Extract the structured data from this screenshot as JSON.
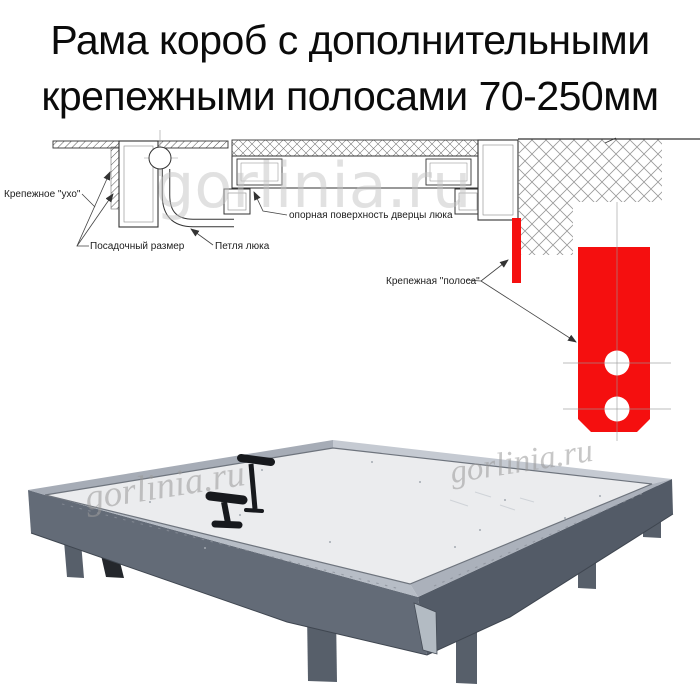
{
  "title": {
    "line1": "Рама короб с дополнительными",
    "line2": "крепежными полосами 70-250мм"
  },
  "diagram": {
    "labels": {
      "fastening_ear": "Крепежное \"ухо\"",
      "mounting_size": "Посадочный размер",
      "hatch_hinge": "Петля люка",
      "bearing_surface": "опорная поверхность дверцы люка",
      "fastening_strip": "Крепежная \"полоса\""
    }
  },
  "watermark": {
    "text": "gorlinia.ru"
  },
  "colors": {
    "strip_red": "#f50f0f",
    "steel_dark": "#636b77",
    "steel_darker": "#535b67",
    "aluminum": "#b7bdc6",
    "panel": "#ebecee"
  }
}
